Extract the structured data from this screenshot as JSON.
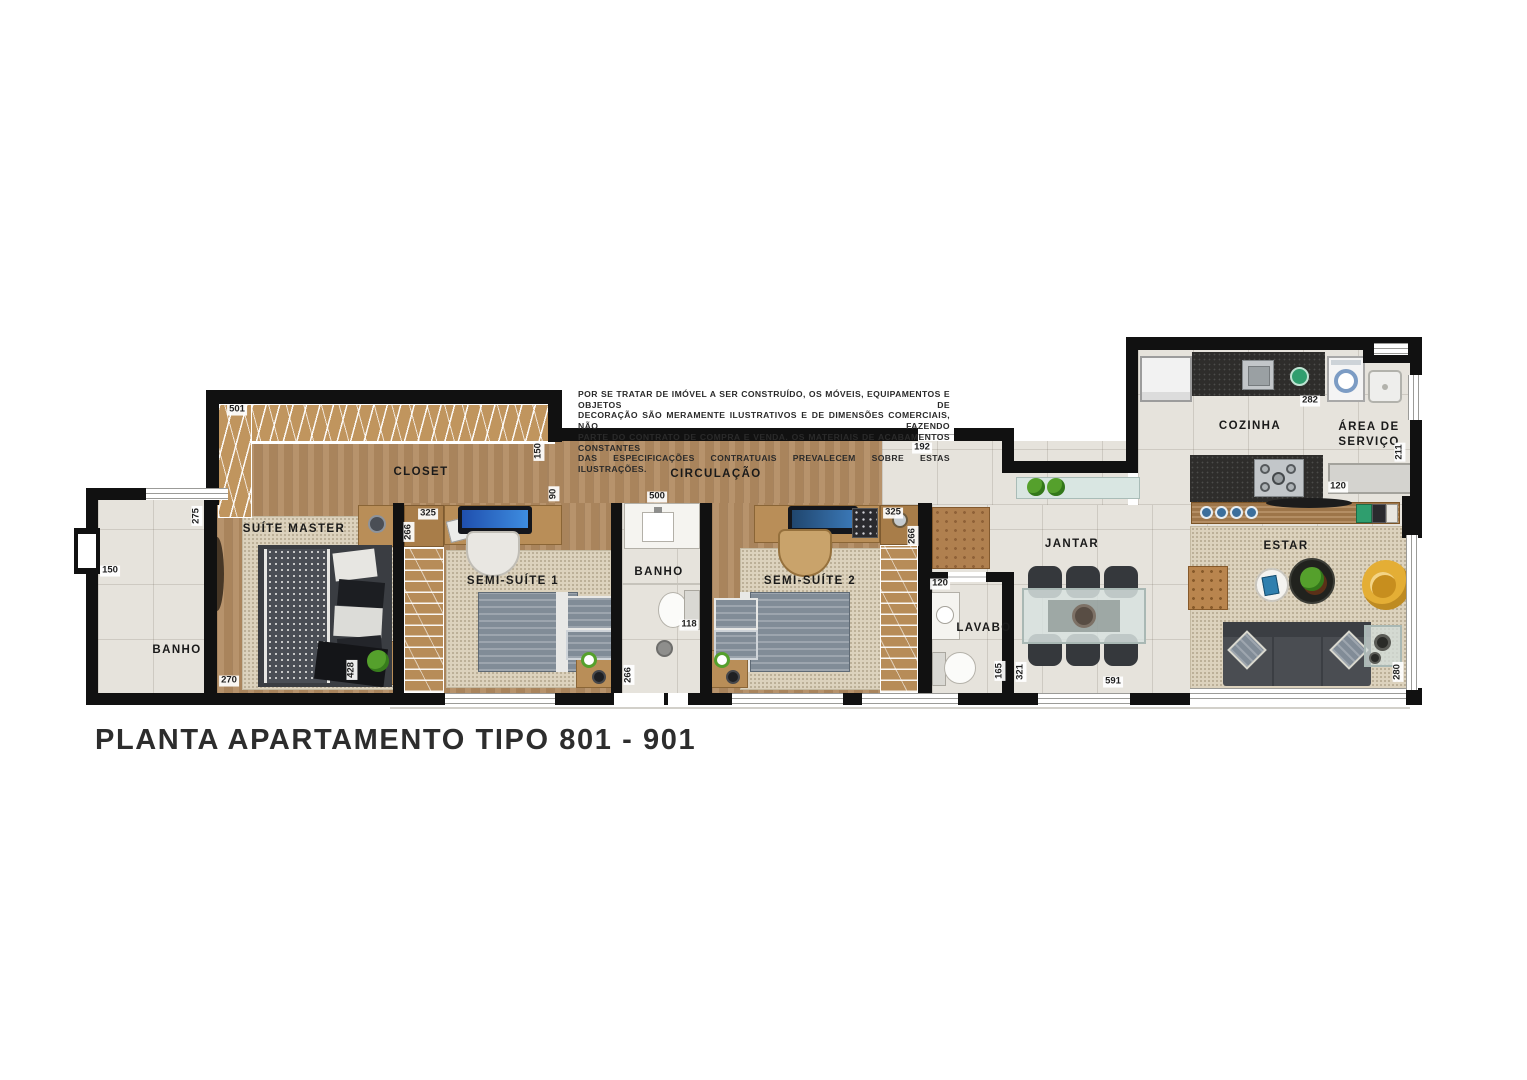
{
  "title": "PLANTA APARTAMENTO TIPO 801 - 901",
  "disclaimer": {
    "line1": "POR SE TRATAR DE IMÓVEL A SER CONSTRUÍDO, OS MÓVEIS, EQUIPAMENTOS E OBJETOS DE",
    "line2": "DECORAÇÃO SÃO MERAMENTE ILUSTRATIVOS E DE DIMENSÕES COMERCIAIS, NÃO FAZENDO",
    "line3": "PARTE DO CONTRATO DE COMPRA E VENDA. OS MATERIAIS DE ACABAMENTOS CONSTANTES",
    "line4": "DAS ESPECIFICAÇÕES CONTRATUAIS PREVALECEM SOBRE ESTAS ILUSTRAÇÕES."
  },
  "rooms": {
    "banho_esquerdo": "BANHO",
    "suite_master": "SUÍTE MASTER",
    "closet": "CLOSET",
    "semi_suite_1": "SEMI-SUÍTE 1",
    "circulacao": "CIRCULAÇÃO",
    "banho_meio": "BANHO",
    "semi_suite_2": "SEMI-SUÍTE 2",
    "lavabo": "LAVABO",
    "jantar": "JANTAR",
    "cozinha": "COZINHA",
    "area_servico": "ÁREA DE SERVIÇO",
    "estar": "ESTAR"
  },
  "dimensions": {
    "closet_largura": "501",
    "closet_dir_150": "150",
    "closet_dir_90": "90",
    "banho_esq_275": "275",
    "banho_esq_150": "150",
    "suite_master_270": "270",
    "suite_master_428": "428",
    "semi_suite1_325": "325",
    "semi_suite1_266": "266",
    "banho_meio_500": "500",
    "banho_meio_118": "118",
    "banho_meio_266": "266",
    "semi_suite2_325": "325",
    "semi_suite2_266": "266",
    "hall_192": "192",
    "lavabo_120": "120",
    "lavabo_165": "165",
    "jantar_321": "321",
    "jantar_591": "591",
    "cozinha_282": "282",
    "servico_211": "211",
    "cozinha_120": "120",
    "estar_280": "280"
  },
  "colors": {
    "wall": "#111111",
    "wood_floor": "#b28b61",
    "tile_floor": "#e6e3dc",
    "rug": "#dcd2bd",
    "furniture_wood": "#b98e58",
    "dark_counter": "#2e2d2b",
    "plate_blue": "#3c6f9c",
    "plant_green": "#55a02c",
    "armchair_yellow": "#e4ae35",
    "sofa_gray": "#4a4d52"
  }
}
